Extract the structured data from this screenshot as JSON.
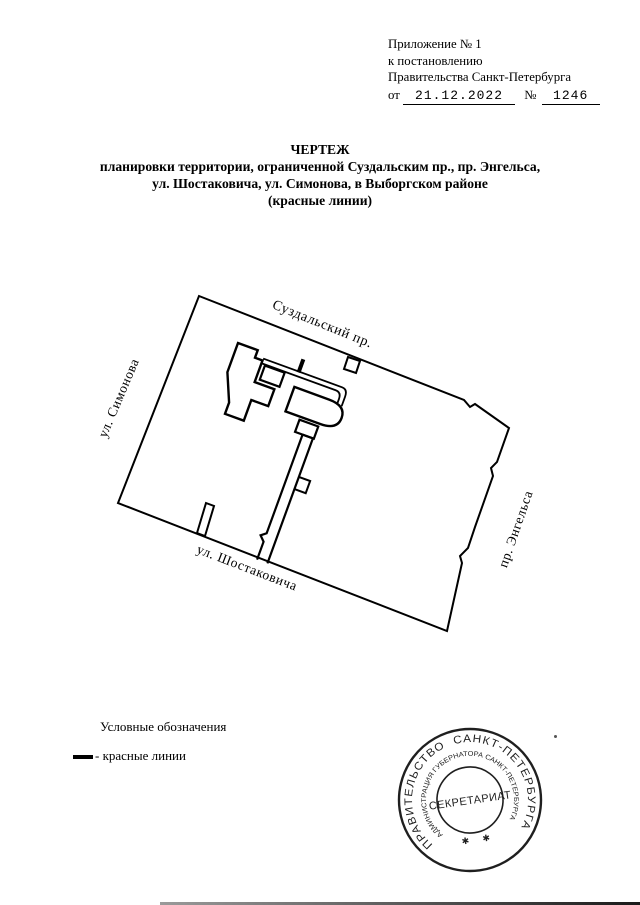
{
  "document": {
    "header": {
      "line1": "Приложение № 1",
      "line2": "к постановлению",
      "line3": "Правительства Санкт-Петербурга",
      "from_label": "от",
      "date": "21.12.2022",
      "no_label": "№",
      "number": "1246"
    },
    "title": {
      "line1": "ЧЕРТЕЖ",
      "line2": "планировки территории, ограниченной  Суздальским пр., пр. Энгельса,",
      "line3": "ул. Шостаковича, ул. Симонова, в Выборгском районе",
      "line4": "(красные линии)"
    },
    "map": {
      "street_top": "Суздальский пр.",
      "street_left": "ул. Симонова",
      "street_bottom": "ул. Шостаковича",
      "street_right": "пр. Энгельса"
    },
    "legend": {
      "heading": "Условные обозначения",
      "red_lines_label": "- красные линии"
    },
    "stamp": {
      "outer_ring": "ПРАВИТЕЛЬСТВО  САНКТ-ПЕТЕРБУРГА",
      "inner_ring": "АДМИНИСТРАЦИЯ ГУБЕРНАТОРА САНКТ-ПЕТЕРБУРГА",
      "center": "СЕКРЕТАРИАТ",
      "star": "✱"
    },
    "colors": {
      "ink": "#000000",
      "stamp_ink": "#1f1f1f",
      "paper": "#ffffff"
    }
  }
}
